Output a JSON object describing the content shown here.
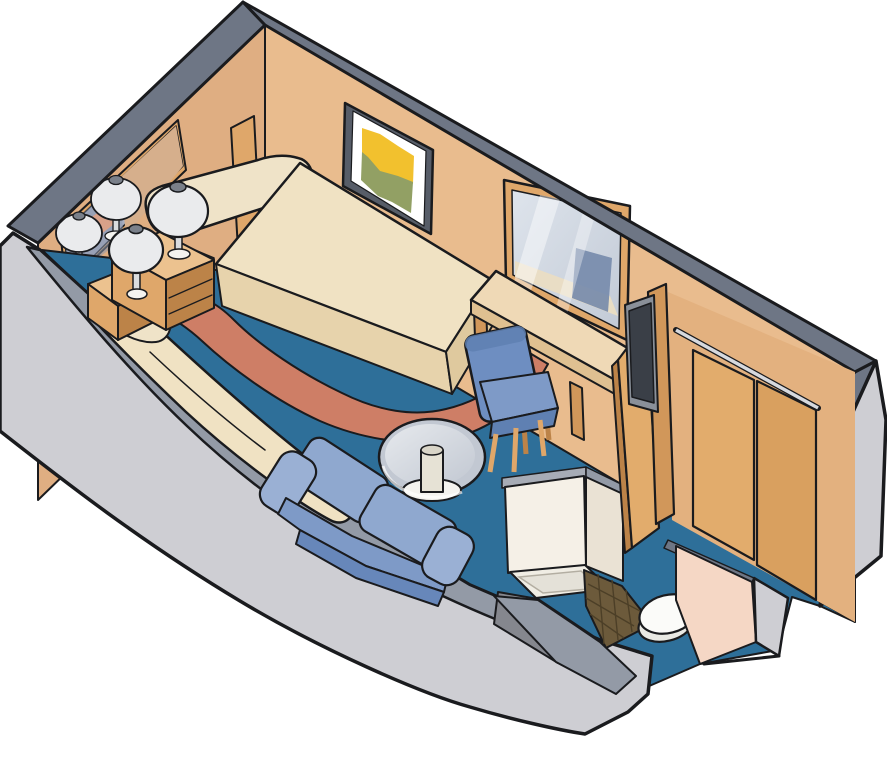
{
  "scene": {
    "kind": "isometric-cutaway-floorplan",
    "subject": "cruise-ship-interior-stateroom",
    "items": [
      "twin-bed",
      "bolster-pillow",
      "headboard-panel",
      "head-wall-mirror",
      "nightstand",
      "table-lamp",
      "table-lamp-reflections",
      "wall-artwork",
      "day-bed",
      "sofa",
      "round-glass-table",
      "desk",
      "vanity-mirror",
      "desk-chair",
      "television",
      "closet",
      "closet-rod",
      "closet-doors",
      "open-closet-door",
      "bathroom",
      "shower-stall",
      "shower-tray",
      "tile-floor",
      "toilet",
      "carpet",
      "bed-runner-rug",
      "hull-wall",
      "entryway"
    ]
  },
  "palette": {
    "ink": "#1A1B1E",
    "wallTan": "#E9BC8E",
    "wallTanDeep": "#DFAE82",
    "closetWall": "#E3B17F",
    "bandDark": "#6E7685",
    "bandMid": "#939AA6",
    "bandLight": "#A7ACB6",
    "hullFace": "#CECED3",
    "floorBlue": "#2E6F99",
    "salmon": "#CE7E66",
    "salmonSoft": "#D8A189",
    "cream": "#F0E2C3",
    "creamShade": "#E7D3AC",
    "creamDeep": "#DFC99E",
    "pillow": "#EFE3C8",
    "woodLight": "#ECC28F",
    "wood": "#DFA76A",
    "woodMid": "#D1975A",
    "woodDeep": "#BC8348",
    "doorWood": "#E2AC6C",
    "doorWood2": "#D9A05F",
    "sofaLight": "#9AB0D4",
    "sofa": "#8FA8CF",
    "sofaSeat": "#7E9AC7",
    "sofaDark": "#6787BA",
    "chairBlue": "#6E8EC1",
    "chairDark": "#5F80B2",
    "glass": "#C2C8D2",
    "glassLight": "#E6E9ED",
    "pedestal": "#E6E2D5",
    "pedestalTop": "#D9D5C8",
    "baseWhite": "#F4F3EF",
    "mirrorBlue": "#A7AEC0",
    "mirrorShadow": "#8C97AD",
    "mirrorTan": "#D6AF8C",
    "vanGlassA": "#DEE4EC",
    "vanGlassB": "#C2CAD6",
    "reflChair": "#7589AB",
    "reflDesk": "#EADDC3",
    "tvFrame": "#8A9099",
    "tvScreen": "#3A3F47",
    "rodLight": "#D6D9DE",
    "showerWhite": "#F5F0E7",
    "showerSide": "#EAE2D4",
    "tray": "#F0EDE4",
    "trayInner": "#E4E1D8",
    "bathFloor": "#85878E",
    "arcLight": "#CDCFD4",
    "tile": "#6C5A3B",
    "tileLine": "#4C3F27",
    "toiletWhite": "#FBFBF9",
    "toiletRim": "#E9E9E4",
    "pinkWall": "#F5D7C5",
    "artYellow": "#F2C12E",
    "artGreen": "#92A064",
    "matte": "#FFFFFF",
    "frameGray": "#575D68",
    "lampShade": "#EAEBED",
    "lampCap": "#7A808A",
    "lampStem": "#DADCDE",
    "deskTop": "#EFD9B6",
    "deskFront": "#DFC091",
    "white": "#FFFFFF"
  }
}
